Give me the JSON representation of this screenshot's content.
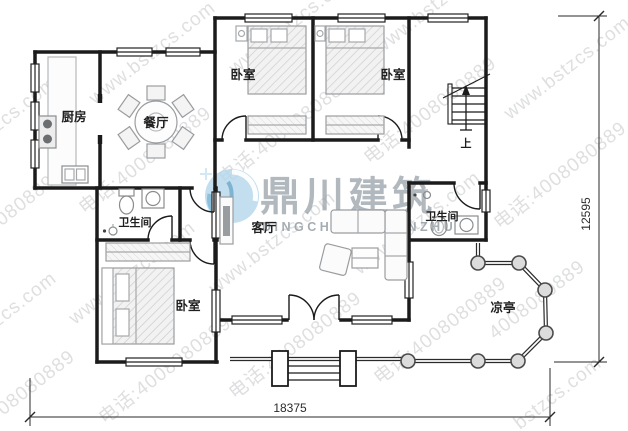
{
  "rooms": {
    "kitchen": "厨房",
    "dining": "餐厅",
    "bedroom_top_left": "卧室",
    "bedroom_top_right": "卧室",
    "bedroom_bottom": "卧室",
    "bathroom_left": "卫生间",
    "bathroom_right": "卫生间",
    "living": "客厅",
    "pavilion": "凉亭",
    "stairs_up": "上"
  },
  "dimensions": {
    "bottom_width": "18375",
    "right_height": "12595"
  },
  "watermark": {
    "logo_cn": "鼎川建筑",
    "logo_en": "DINGCHUAN-JIANZHU",
    "tiled_lines": [
      "www.bstzcs.com",
      "电话:4008080889",
      "bstzcs.com",
      "4008080889"
    ]
  },
  "colors": {
    "wall": "#1b1b1b",
    "furniture": "#a5a8aa",
    "watermark_text": "#9ba0a5",
    "logo_blue": "#b5d7eb",
    "logo_blue_dark": "#79b5d6",
    "logo_text_gray": "#97a0a8",
    "dimension": "#2a2a2a",
    "background": "#ffffff"
  }
}
